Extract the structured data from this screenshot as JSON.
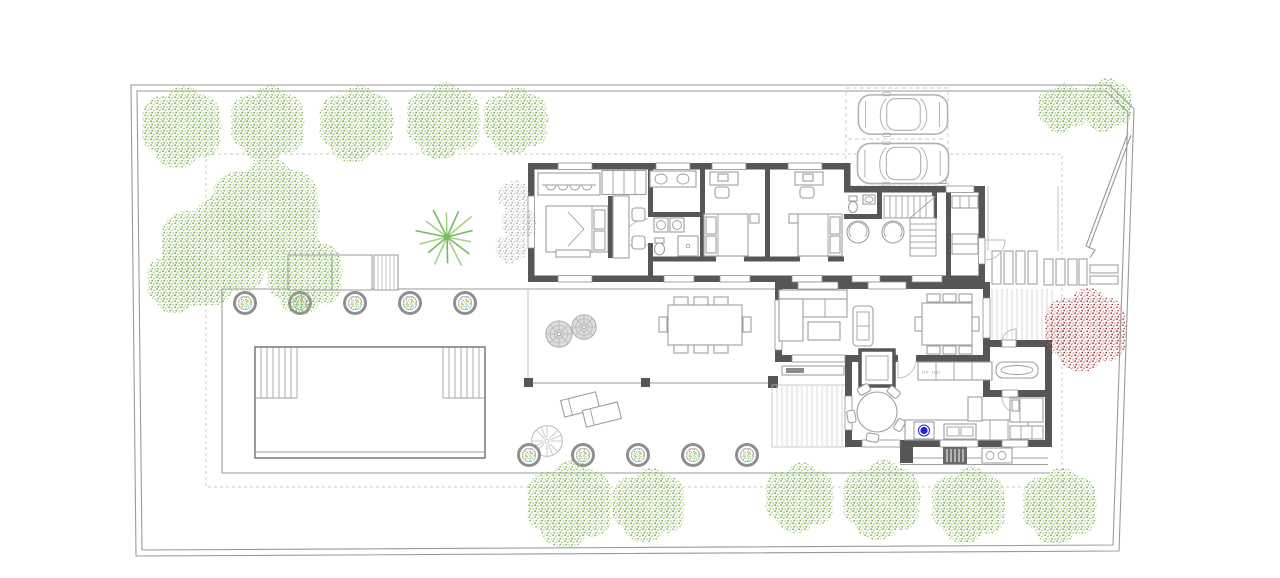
{
  "labels": {
    "kitchen_appliance": "PF HO"
  },
  "palette": {
    "paper": "#ffffff",
    "wall": "#565656",
    "furniture_line": "#9e9e9e",
    "boundary_line": "#9a9a9a",
    "light_line": "#c9c9c9",
    "pool_line": "#6f6f6f",
    "tree_green": "#8cbe65",
    "tree_green_light": "#a7d286",
    "tree_red": "#b5504b",
    "tree_gray": "#bdbdbd",
    "planter_teal": "#79c0ae",
    "planter_yellow": "#d9cf52",
    "planter_ring": "#8f8f8f",
    "stove_accent": "#2222dd"
  },
  "landscape": {
    "green_trees": [
      {
        "x": 182,
        "y": 127,
        "r": 44
      },
      {
        "x": 268,
        "y": 124,
        "r": 41
      },
      {
        "x": 357,
        "y": 124,
        "r": 41
      },
      {
        "x": 444,
        "y": 121,
        "r": 41
      },
      {
        "x": 516,
        "y": 121,
        "r": 36
      },
      {
        "x": 1063,
        "y": 108,
        "r": 27
      },
      {
        "x": 1106,
        "y": 105,
        "r": 29
      },
      {
        "x": 214,
        "y": 252,
        "r": 58
      },
      {
        "x": 266,
        "y": 214,
        "r": 60
      },
      {
        "x": 305,
        "y": 275,
        "r": 42
      },
      {
        "x": 178,
        "y": 282,
        "r": 34
      },
      {
        "x": 570,
        "y": 504,
        "r": 47
      },
      {
        "x": 649,
        "y": 505,
        "r": 40
      },
      {
        "x": 800,
        "y": 498,
        "r": 38
      },
      {
        "x": 882,
        "y": 500,
        "r": 43
      },
      {
        "x": 969,
        "y": 505,
        "r": 41
      },
      {
        "x": 1060,
        "y": 506,
        "r": 41
      }
    ],
    "red_trees": [
      {
        "x": 1086,
        "y": 330,
        "r": 45
      }
    ],
    "gray_trees": [
      {
        "x": 514,
        "y": 196,
        "r": 17
      },
      {
        "x": 519,
        "y": 223,
        "r": 19
      },
      {
        "x": 511,
        "y": 248,
        "r": 17
      }
    ],
    "planters": [
      {
        "x": 245,
        "y": 303
      },
      {
        "x": 300,
        "y": 303
      },
      {
        "x": 355,
        "y": 303
      },
      {
        "x": 410,
        "y": 303
      },
      {
        "x": 465,
        "y": 303
      },
      {
        "x": 529,
        "y": 455
      },
      {
        "x": 583,
        "y": 455
      },
      {
        "x": 638,
        "y": 455
      },
      {
        "x": 693,
        "y": 455
      },
      {
        "x": 747,
        "y": 455
      }
    ],
    "spiral_shrubs": [
      {
        "x": 559,
        "y": 334,
        "r": 15
      },
      {
        "x": 584,
        "y": 327,
        "r": 14
      }
    ],
    "parasols": [
      {
        "x": 547,
        "y": 441,
        "r": 18
      }
    ],
    "palm": {
      "x": 447,
      "y": 237,
      "r": 34
    }
  },
  "vehicles": {
    "cars": [
      {
        "x": 857,
        "y": 92,
        "w": 92,
        "h": 45
      },
      {
        "x": 855,
        "y": 141,
        "w": 96,
        "h": 45
      }
    ]
  }
}
